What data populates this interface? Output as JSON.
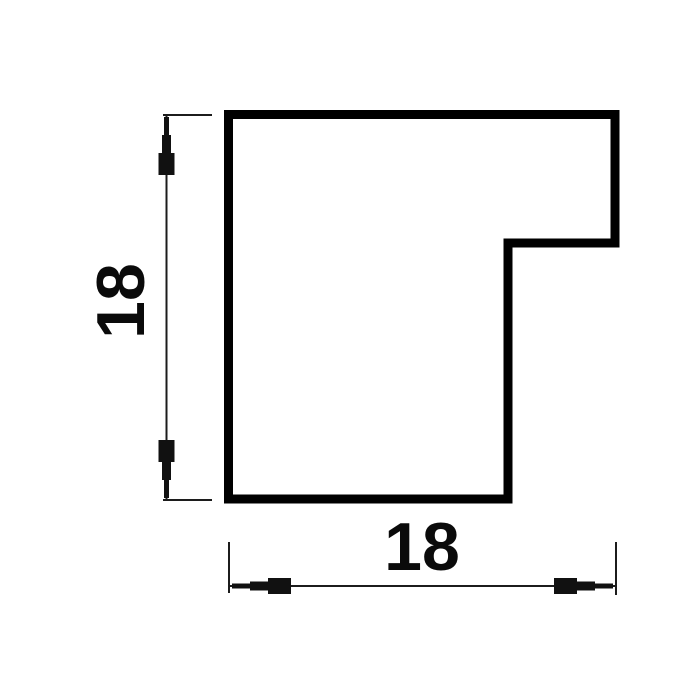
{
  "drawing": {
    "kind": "profile-cross-section",
    "height_dimension": {
      "value": "18"
    },
    "width_dimension": {
      "value": "18"
    },
    "colors": {
      "outline": "#000000",
      "dimension_lines": "#1c1c1c",
      "background": "#ffffff"
    }
  }
}
